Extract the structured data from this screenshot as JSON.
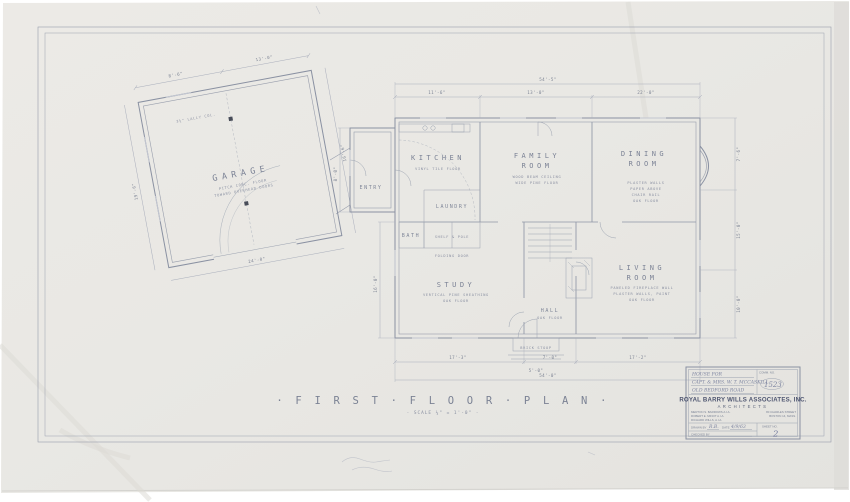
{
  "plan": {
    "title": "· F I R S T  ·  F L O O R  ·  P L A N ·",
    "scale": "· SCALE ¼\" = 1'-0\" ·"
  },
  "rooms": {
    "garage": {
      "label": "GARAGE",
      "note1": "PITCH CONC. FLOOR",
      "note2": "TOWARD OVERHEAD DOORS",
      "post_note": "3½\" LALLY COL."
    },
    "kitchen": {
      "label": "KITCHEN",
      "note1": "VINYL TILE FLOOR"
    },
    "family": {
      "label": "FAMILY",
      "label2": "ROOM",
      "note1": "WOOD BEAM CEILING",
      "note2": "WIDE PINE FLOOR"
    },
    "dining": {
      "label": "DINING",
      "label2": "ROOM",
      "note1": "PLASTER WALLS",
      "note2": "PAPER ABOVE",
      "note3": "CHAIR RAIL",
      "note4": "OAK FLOOR"
    },
    "living": {
      "label": "LIVING",
      "label2": "ROOM",
      "note1": "PANELED FIREPLACE WALL",
      "note2": "PLASTER WALLS, PAINT",
      "note3": "OAK FLOOR"
    },
    "study": {
      "label": "STUDY",
      "note1": "VERTICAL PINE SHEATHING",
      "note2": "OAK FLOOR"
    },
    "hall": {
      "label": "HALL",
      "note1": "OAK FLOOR"
    },
    "entry": {
      "label": "ENTRY"
    },
    "laundry": {
      "label": "LAUNDRY"
    },
    "bath": {
      "label": "BATH"
    },
    "closet_a": {
      "label": "SHELF & POLE"
    },
    "closet_b": {
      "label": "FOLDING DOOR"
    },
    "porch": {
      "label": "BRICK STOOP"
    }
  },
  "dims": [
    "8'-6\"",
    "13'-0\"",
    "16'-6\"",
    "24'-0\"",
    "19'-6\"",
    "54'-5\"",
    "11'-6\"",
    "13'-0\"",
    "22'-0\"",
    "7'-6\"",
    "15'-0\"",
    "10'-0\"",
    "54'-0\"",
    "17'-3\"",
    "7'-0\"",
    "17'-2\"",
    "16'-0\"",
    "5'-0\"",
    "8'-0\""
  ],
  "title_block": {
    "house_for": "HOUSE FOR",
    "client": "CAPT. & MRS. W. T. MCCASKILL",
    "project": "OLD BEDFORD ROAD",
    "comm_no_label": "COMM. NO.",
    "comm_no": "1523",
    "firm": "ROYAL BARRY WILLS ASSOCIATES, INC.",
    "firm_sub": "ARCHITECTS",
    "name1": "MERTON S. BARROWS A.I.A.",
    "name2": "ROBERT E. MINOT A.I.A.",
    "name3": "RICHARD WILLS, A.I.A.",
    "addr1": "80 CHARLES STREET",
    "addr2": "BOSTON 14, MASS.",
    "drawn_by_label": "DRAWN BY",
    "drawn_by": "R.B.",
    "date_label": "DATE",
    "date": "4/9/63",
    "checked_by_label": "CHECKED BY",
    "sheet_no_label": "SHEET NO.",
    "sheet_no": "2"
  }
}
